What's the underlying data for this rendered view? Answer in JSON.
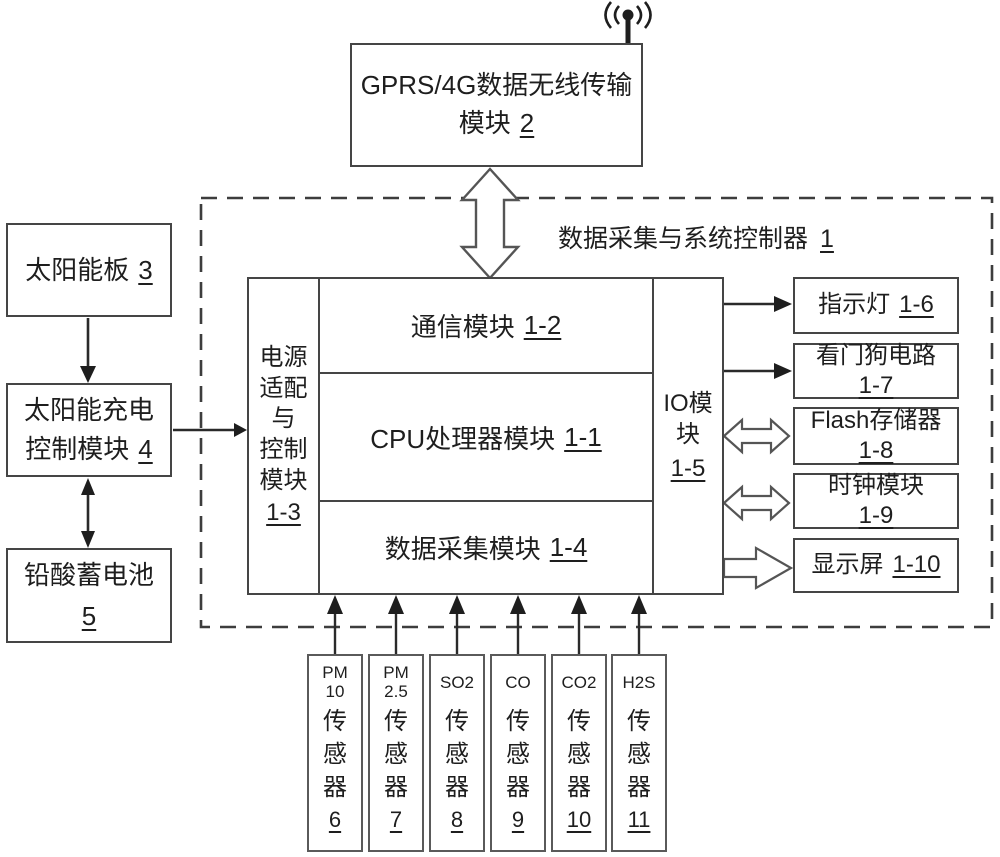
{
  "colors": {
    "ink": "#1e1e1e",
    "line": "#333333",
    "hollow_stroke": "#555555",
    "background": "#ffffff"
  },
  "antenna": {
    "icon": "wireless-signal-icon"
  },
  "gprs": {
    "label": "GPRS/4G数据无线传输模块",
    "ref": "2"
  },
  "controller": {
    "title": "数据采集与系统控制器",
    "ref": "1"
  },
  "power_column": {
    "label": "电源\n适配\n与\n控制\n模块",
    "ref": "1-3"
  },
  "modules": [
    {
      "label": "通信模块",
      "ref": "1-2"
    },
    {
      "label": "CPU处理器模块",
      "ref": "1-1"
    },
    {
      "label": "数据采集模块",
      "ref": "1-4"
    }
  ],
  "io_column": {
    "label": "IO模\n块",
    "ref": "1-5"
  },
  "peripherals": [
    {
      "label": "指示灯",
      "ref": "1-6"
    },
    {
      "label": "看门狗电路",
      "ref": "1-7"
    },
    {
      "label": "Flash存储器",
      "ref": "1-8"
    },
    {
      "label": "时钟模块",
      "ref": "1-9"
    },
    {
      "label": "显示屏",
      "ref": "1-10"
    }
  ],
  "power_chain": [
    {
      "label": "太阳能板",
      "ref": "3"
    },
    {
      "label": "太阳能充电控制模块",
      "ref": "4"
    },
    {
      "label": "铅酸蓄电池",
      "ref": "5"
    }
  ],
  "sensors": [
    {
      "gas": "PM\n10",
      "label": "传\n感\n器",
      "ref": "6"
    },
    {
      "gas": "PM\n2.5",
      "label": "传\n感\n器",
      "ref": "7"
    },
    {
      "gas": "SO2",
      "label": "传\n感\n器",
      "ref": "8"
    },
    {
      "gas": "CO",
      "label": "传\n感\n器",
      "ref": "9"
    },
    {
      "gas": "CO2",
      "label": "传\n感\n器",
      "ref": "10"
    },
    {
      "gas": "H2S",
      "label": "传\n感\n器",
      "ref": "11"
    }
  ]
}
